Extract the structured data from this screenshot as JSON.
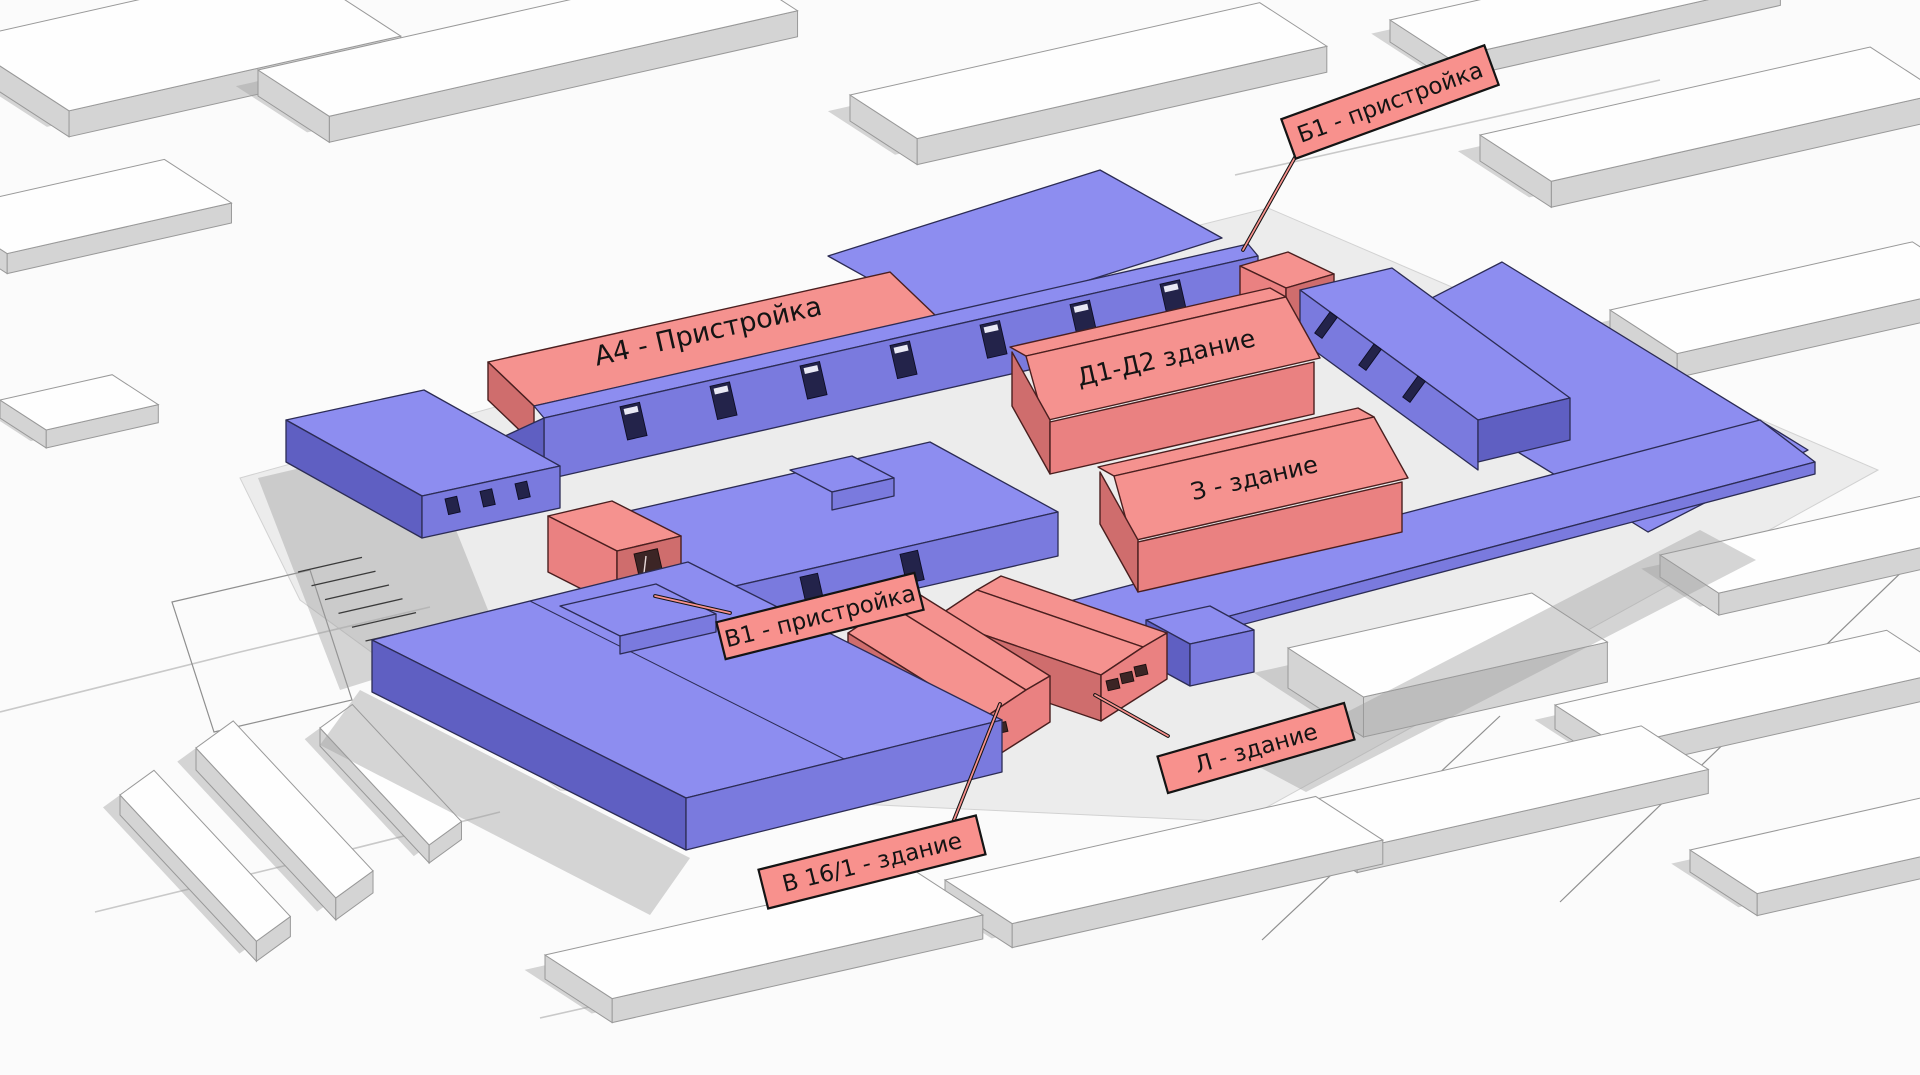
{
  "palette": {
    "bg": "#fbfbfb",
    "ground": "#ececec",
    "ctx-top": "#fefefe",
    "ctx-side": "#d4d4d4",
    "shadow": "#9e9e9e",
    "line": "#c9c9c9",
    "blue-top": "#8d8df0",
    "blue-wall": "#7a7ade",
    "blue-dark": "#5f5fc2",
    "blue-stroke": "#2c2c55",
    "red-top": "#f5928f",
    "red-wall": "#ea8181",
    "red-dark": "#cf6d6d",
    "red-stroke": "#4a1f1f",
    "label-bg": "#f8918d",
    "ink": "#141414"
  },
  "legend": {
    "highlighted_color": "#f5928f",
    "existing_color": "#8d8df0"
  },
  "buildings": {
    "a4": {
      "label": "А4 - Пристройка",
      "style": "roof-text"
    },
    "d1d2": {
      "label": "Д1-Д2 здание",
      "style": "roof-text"
    },
    "z": {
      "label": "З - здание",
      "style": "roof-text"
    },
    "b1": {
      "label": "Б1 - пристройка",
      "style": "callout"
    },
    "v1": {
      "label": "В1 - пристройка",
      "style": "callout"
    },
    "l": {
      "label": "Л - здание",
      "style": "callout"
    },
    "v161": {
      "label": "В 16/1 - здание",
      "style": "callout"
    }
  }
}
